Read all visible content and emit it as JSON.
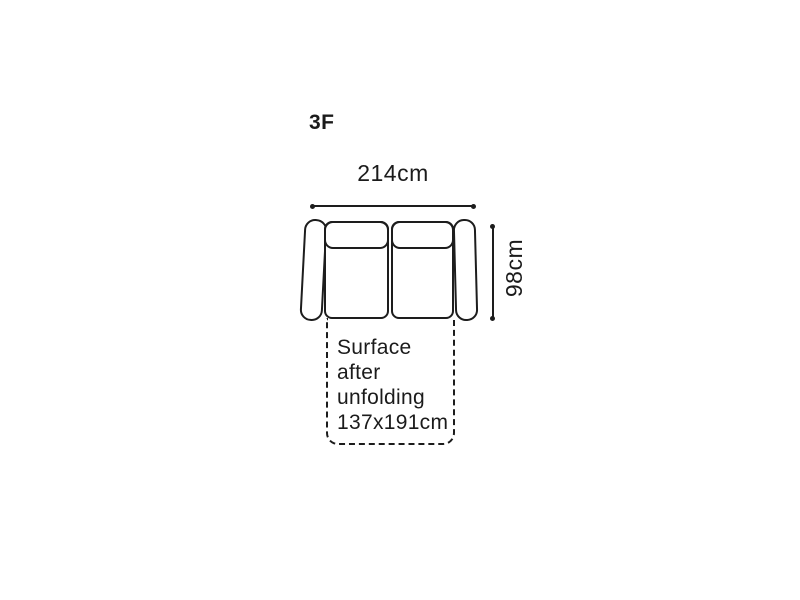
{
  "diagram": {
    "model_label": "3F",
    "width_dimension": "214cm",
    "depth_dimension": "98cm",
    "unfold_note": {
      "text": "Surface after unfolding 137x191cm",
      "lines": [
        "Surface",
        "after",
        "unfolding",
        "137x191cm"
      ]
    },
    "colors": {
      "stroke": "#1d1d1d",
      "text": "#1b1b1b",
      "background": "#ffffff"
    }
  }
}
